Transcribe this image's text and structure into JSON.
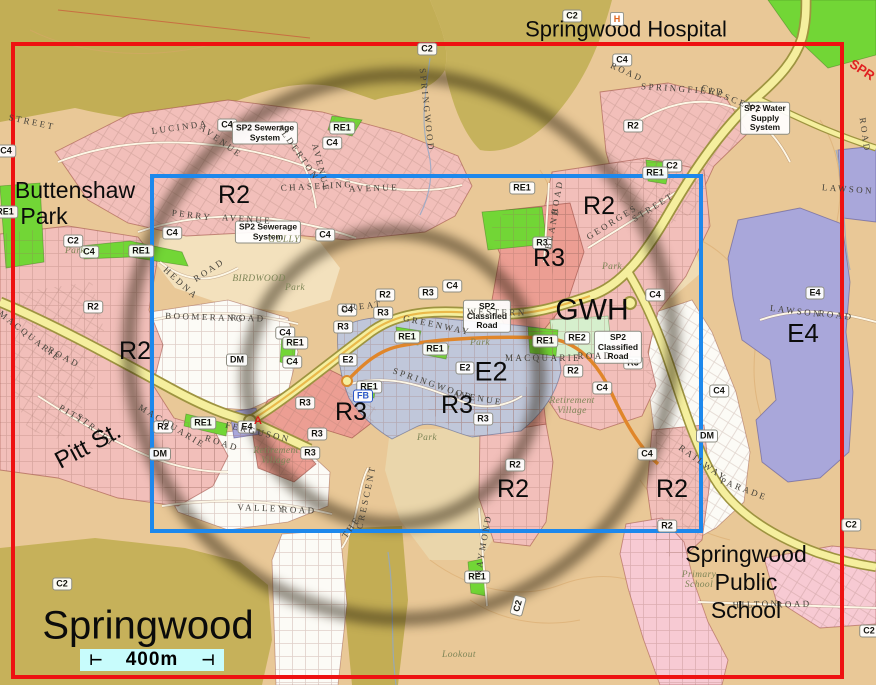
{
  "map": {
    "palette": {
      "red_frame": "#ee1111",
      "blue_frame": "#1d88ec",
      "ring_color": "rgba(38,28,10,0.5)",
      "scale_bar_bg": "#c8fcfc",
      "zone_r2": "#f2bfba",
      "zone_r3": "#ec9e93",
      "zone_e2": "#c0c7da",
      "zone_e4": "#a9a7da",
      "zone_re1": "#72d636",
      "zone_re2": "#d6efcd",
      "road_yellow": "#f5ef9e"
    },
    "overlays": {
      "red_frame": {
        "x": 11,
        "y": 42,
        "w": 833,
        "h": 637,
        "thickness": 4
      },
      "blue_frame": {
        "x": 150,
        "y": 174,
        "w": 553,
        "h": 359,
        "thickness": 4
      },
      "radius_rings": {
        "thickness": 14,
        "blur": 5,
        "circles": [
          {
            "cx": 401,
            "cy": 347,
            "r": 272
          },
          {
            "cx": 393,
            "cy": 378,
            "r": 146
          }
        ]
      }
    },
    "scale_bar": {
      "x": 80,
      "y": 649,
      "w": 144,
      "h": 22,
      "label": "400m",
      "tick_left": "⊢",
      "tick_right": "⊣"
    },
    "big_labels": [
      {
        "text": "Springwood Hospital",
        "x": 626,
        "y": 30,
        "size": 22
      },
      {
        "text": "Buttenshaw",
        "x": 75,
        "y": 190,
        "size": 23
      },
      {
        "text": "Park",
        "x": 44,
        "y": 216,
        "size": 23
      },
      {
        "text": "R2",
        "x": 234,
        "y": 195,
        "size": 25
      },
      {
        "text": "R2",
        "x": 599,
        "y": 206,
        "size": 25
      },
      {
        "text": "R3",
        "x": 549,
        "y": 258,
        "size": 25
      },
      {
        "text": "GWH",
        "x": 592,
        "y": 311,
        "size": 30
      },
      {
        "text": "E4",
        "x": 803,
        "y": 334,
        "size": 26
      },
      {
        "text": "R2",
        "x": 135,
        "y": 351,
        "size": 25
      },
      {
        "text": "E2",
        "x": 491,
        "y": 372,
        "size": 27
      },
      {
        "text": "R3",
        "x": 351,
        "y": 412,
        "size": 25
      },
      {
        "text": "R3",
        "x": 457,
        "y": 405,
        "size": 25
      },
      {
        "text": "Pitt St.",
        "x": 88,
        "y": 446,
        "size": 24,
        "rot": -28
      },
      {
        "text": "R2",
        "x": 513,
        "y": 489,
        "size": 25
      },
      {
        "text": "R2",
        "x": 672,
        "y": 489,
        "size": 25
      },
      {
        "text": "Springwood\nPublic\nSchool",
        "x": 746,
        "y": 582,
        "size": 23
      },
      {
        "text": "Springwood",
        "x": 148,
        "y": 626,
        "size": 40
      },
      {
        "text": "SPR",
        "x": 862,
        "y": 70,
        "size": 13,
        "rot": 33,
        "color": "#e02020",
        "weight": 700
      }
    ],
    "zone_pills": [
      {
        "text": "R2",
        "x": 633,
        "y": 126
      },
      {
        "text": "R2",
        "x": 93,
        "y": 307
      },
      {
        "text": "R2",
        "x": 385,
        "y": 295
      },
      {
        "text": "R2",
        "x": 573,
        "y": 371
      },
      {
        "text": "R2",
        "x": 163,
        "y": 427
      },
      {
        "text": "R2",
        "x": 515,
        "y": 465
      },
      {
        "text": "R2",
        "x": 667,
        "y": 526
      },
      {
        "text": "R3",
        "x": 542,
        "y": 243
      },
      {
        "text": "R3",
        "x": 428,
        "y": 293
      },
      {
        "text": "R3",
        "x": 383,
        "y": 313
      },
      {
        "text": "R3",
        "x": 343,
        "y": 327
      },
      {
        "text": "R3",
        "x": 305,
        "y": 403
      },
      {
        "text": "R3",
        "x": 317,
        "y": 434
      },
      {
        "text": "R3",
        "x": 483,
        "y": 419
      },
      {
        "text": "R3",
        "x": 633,
        "y": 363
      },
      {
        "text": "R3",
        "x": 310,
        "y": 453
      },
      {
        "text": "C4",
        "x": 6,
        "y": 151
      },
      {
        "text": "C4",
        "x": 227,
        "y": 125
      },
      {
        "text": "C4",
        "x": 332,
        "y": 143
      },
      {
        "text": "C4",
        "x": 622,
        "y": 60
      },
      {
        "text": "C4",
        "x": 172,
        "y": 233
      },
      {
        "text": "C4",
        "x": 325,
        "y": 235
      },
      {
        "text": "C4",
        "x": 89,
        "y": 252
      },
      {
        "text": "C4",
        "x": 285,
        "y": 333
      },
      {
        "text": "C4",
        "x": 292,
        "y": 362
      },
      {
        "text": "C4",
        "x": 452,
        "y": 286
      },
      {
        "text": "C4",
        "x": 347,
        "y": 310
      },
      {
        "text": "C4",
        "x": 655,
        "y": 295
      },
      {
        "text": "C4",
        "x": 602,
        "y": 388
      },
      {
        "text": "C4",
        "x": 647,
        "y": 454
      },
      {
        "text": "C4",
        "x": 719,
        "y": 391
      },
      {
        "text": "C2",
        "x": 427,
        "y": 49
      },
      {
        "text": "C2",
        "x": 572,
        "y": 16
      },
      {
        "text": "C2",
        "x": 73,
        "y": 241
      },
      {
        "text": "C2",
        "x": 672,
        "y": 166
      },
      {
        "text": "C2",
        "x": 62,
        "y": 584
      },
      {
        "text": "C2",
        "x": 518,
        "y": 606,
        "rot": -75
      },
      {
        "text": "C2",
        "x": 851,
        "y": 525
      },
      {
        "text": "C2",
        "x": 869,
        "y": 631
      },
      {
        "text": "RE1",
        "x": 5,
        "y": 212
      },
      {
        "text": "RE1",
        "x": 141,
        "y": 251
      },
      {
        "text": "RE1",
        "x": 342,
        "y": 128
      },
      {
        "text": "RE1",
        "x": 407,
        "y": 337
      },
      {
        "text": "RE1",
        "x": 435,
        "y": 349
      },
      {
        "text": "RE1",
        "x": 522,
        "y": 188
      },
      {
        "text": "RE1",
        "x": 545,
        "y": 341
      },
      {
        "text": "RE1",
        "x": 369,
        "y": 387
      },
      {
        "text": "RE1",
        "x": 203,
        "y": 423
      },
      {
        "text": "RE1",
        "x": 295,
        "y": 343
      },
      {
        "text": "RE1",
        "x": 655,
        "y": 173
      },
      {
        "text": "RE1",
        "x": 477,
        "y": 577
      },
      {
        "text": "RE2",
        "x": 577,
        "y": 338
      },
      {
        "text": "E2",
        "x": 348,
        "y": 360
      },
      {
        "text": "E2",
        "x": 465,
        "y": 368
      },
      {
        "text": "E4",
        "x": 815,
        "y": 293
      },
      {
        "text": "E4",
        "x": 247,
        "y": 427
      },
      {
        "text": "DM",
        "x": 237,
        "y": 360
      },
      {
        "text": "DM",
        "x": 160,
        "y": 454
      },
      {
        "text": "DM",
        "x": 707,
        "y": 436
      },
      {
        "text": "FB",
        "x": 363,
        "y": 396
      },
      {
        "text": "SP2 Sewerage\nSystem",
        "x": 265,
        "y": 133
      },
      {
        "text": "SP2 Sewerage\nSystem",
        "x": 268,
        "y": 232
      },
      {
        "text": "SP2\nClassified\nRoad",
        "x": 487,
        "y": 316
      },
      {
        "text": "SP2\nClassified\nRoad",
        "x": 618,
        "y": 347
      },
      {
        "text": "SP2 Water\nSupply\nSystem",
        "x": 765,
        "y": 118
      }
    ],
    "street_labels": [
      {
        "text": "LUCINDA",
        "x": 180,
        "y": 127,
        "rot": -8
      },
      {
        "text": "AVENUE",
        "x": 221,
        "y": 141,
        "rot": 36
      },
      {
        "text": "STREET",
        "x": 32,
        "y": 122,
        "rot": 12
      },
      {
        "text": "ROAD",
        "x": 627,
        "y": 72,
        "rot": 24
      },
      {
        "text": "SPRINGFIELD",
        "x": 683,
        "y": 89,
        "rot": 4
      },
      {
        "text": "CRESCENT",
        "x": 732,
        "y": 99,
        "rot": 22
      },
      {
        "text": "CHASELING",
        "x": 317,
        "y": 186,
        "rot": -3
      },
      {
        "text": "AVENUE",
        "x": 374,
        "y": 188,
        "rot": -2
      },
      {
        "text": "PERRY",
        "x": 192,
        "y": 215,
        "rot": 7
      },
      {
        "text": "AVENUE",
        "x": 247,
        "y": 219,
        "rot": 4
      },
      {
        "text": "ALDERTON",
        "x": 298,
        "y": 152,
        "rot": 55
      },
      {
        "text": "AVENUE",
        "x": 321,
        "y": 168,
        "rot": 76
      },
      {
        "text": "GEORGES",
        "x": 612,
        "y": 222,
        "rot": -32
      },
      {
        "text": "STREET",
        "x": 653,
        "y": 207,
        "rot": -32
      },
      {
        "text": "BLAND",
        "x": 552,
        "y": 228,
        "rot": -78
      },
      {
        "text": "ROAD",
        "x": 557,
        "y": 197,
        "rot": -80
      },
      {
        "text": "HEDNA",
        "x": 181,
        "y": 283,
        "rot": 42
      },
      {
        "text": "ROAD",
        "x": 209,
        "y": 270,
        "rot": -33
      },
      {
        "text": "BOOMERANG",
        "x": 205,
        "y": 317,
        "rot": 2
      },
      {
        "text": "ROAD",
        "x": 248,
        "y": 318,
        "rot": 2
      },
      {
        "text": "MACQUARIE",
        "x": 30,
        "y": 336,
        "rot": 38
      },
      {
        "text": "ROAD",
        "x": 64,
        "y": 357,
        "rot": 28
      },
      {
        "text": "MACQUARIE",
        "x": 172,
        "y": 426,
        "rot": 31
      },
      {
        "text": "ROAD",
        "x": 222,
        "y": 443,
        "rot": 18
      },
      {
        "text": "GREAT",
        "x": 362,
        "y": 306,
        "rot": -6
      },
      {
        "text": "WESTERN",
        "x": 497,
        "y": 312,
        "rot": 1
      },
      {
        "text": "GREENWAY",
        "x": 437,
        "y": 325,
        "rot": 12
      },
      {
        "text": "MACQUARIE",
        "x": 543,
        "y": 358,
        "rot": 0
      },
      {
        "text": "ROAD",
        "x": 595,
        "y": 356,
        "rot": 0
      },
      {
        "text": "SPRINGWOOD",
        "x": 433,
        "y": 384,
        "rot": 19
      },
      {
        "text": "AVENUE",
        "x": 478,
        "y": 398,
        "rot": 10
      },
      {
        "text": "FERGUSON",
        "x": 258,
        "y": 432,
        "rot": 13
      },
      {
        "text": "PITT",
        "x": 72,
        "y": 414,
        "rot": 31
      },
      {
        "text": "STREET",
        "x": 96,
        "y": 430,
        "rot": 39
      },
      {
        "text": "VALLEY",
        "x": 262,
        "y": 508,
        "rot": 2
      },
      {
        "text": "ROAD",
        "x": 299,
        "y": 510,
        "rot": 2
      },
      {
        "text": "THE",
        "x": 351,
        "y": 527,
        "rot": -55
      },
      {
        "text": "CRESCENT",
        "x": 366,
        "y": 497,
        "rot": -78
      },
      {
        "text": "RAYMOND",
        "x": 483,
        "y": 545,
        "rot": -80
      },
      {
        "text": "RAILWAY",
        "x": 703,
        "y": 463,
        "rot": 35
      },
      {
        "text": "PARADE",
        "x": 744,
        "y": 489,
        "rot": 21
      },
      {
        "text": "HILTON",
        "x": 756,
        "y": 604,
        "rot": -2
      },
      {
        "text": "ROAD",
        "x": 794,
        "y": 604,
        "rot": -2
      },
      {
        "text": "LAWSON",
        "x": 796,
        "y": 311,
        "rot": 7
      },
      {
        "text": "ROAD",
        "x": 836,
        "y": 315,
        "rot": 7
      },
      {
        "text": "LAWSON",
        "x": 848,
        "y": 189,
        "rot": 4
      },
      {
        "text": "ROAD",
        "x": 865,
        "y": 135,
        "rot": 82
      },
      {
        "text": "SPRINGWOOD",
        "x": 427,
        "y": 110,
        "rot": 84
      }
    ],
    "place_labels": [
      {
        "text": "Park",
        "x": 75,
        "y": 251
      },
      {
        "text": "Park",
        "x": 295,
        "y": 288
      },
      {
        "text": "Park",
        "x": 480,
        "y": 343
      },
      {
        "text": "Park",
        "x": 612,
        "y": 267
      },
      {
        "text": "Park",
        "x": 427,
        "y": 438
      },
      {
        "text": "GULLY",
        "x": 284,
        "y": 240
      },
      {
        "text": "BIRDWOOD",
        "x": 259,
        "y": 279
      },
      {
        "text": "Lookout",
        "x": 459,
        "y": 655
      },
      {
        "text": "Retirement\nVillage",
        "x": 572,
        "y": 406
      },
      {
        "text": "Retirement\nVillage",
        "x": 276,
        "y": 456
      },
      {
        "text": "Primary\nSchool",
        "x": 699,
        "y": 580
      }
    ],
    "icons": [
      {
        "name": "hospital-icon",
        "glyph": "H",
        "x": 617,
        "y": 19
      },
      {
        "name": "marker-a",
        "glyph": "A",
        "x": 258,
        "y": 421
      }
    ]
  }
}
